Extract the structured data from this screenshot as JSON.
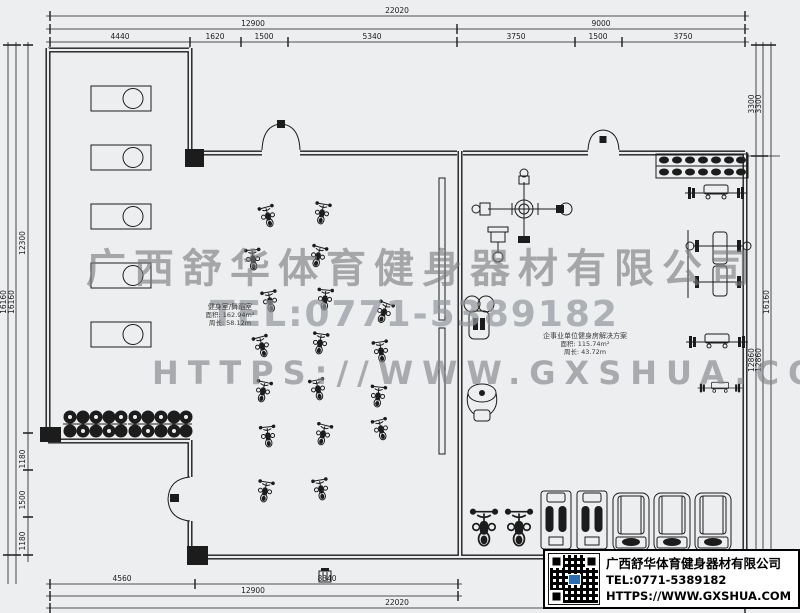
{
  "watermarks": {
    "company": "广西舒华体育健身器材有限公司",
    "tel": "TEL:0771-5389182",
    "website": "HTTPS://WWW.GXSHUA.COM"
  },
  "info_panel": {
    "company": "广西舒华体育健身器材有限公司",
    "tel": "TEL:0771-5389182",
    "website": "HTTPS://WWW.GXSHUA.COM"
  },
  "room_labels": {
    "spin_room": {
      "name": "健身室/舞蹈室",
      "area": "面积: 162.94m²",
      "perimeter": "周长: 58.12m"
    },
    "gym_room": {
      "name": "企事业单位健身房解决方案",
      "area": "面积: 115.74m²",
      "perimeter": "周长: 43.72m"
    }
  },
  "dims": {
    "t1": [
      "22020"
    ],
    "t2": [
      "12900",
      "9000"
    ],
    "t3": [
      "4440",
      "1620",
      "1500",
      "5340",
      "3750",
      "1500",
      "3750"
    ],
    "b1": [
      "4560",
      "8340"
    ],
    "b2": [
      "12900"
    ],
    "b3": [
      "22020"
    ],
    "l": [
      "16160",
      "16160",
      "12300",
      "1180",
      "1500",
      "1180"
    ],
    "r": [
      "3300",
      "3300",
      "12860",
      "12860",
      "16160"
    ]
  },
  "equipment_icons": [
    "treadmill-icon",
    "spin-bike-icon",
    "dumbbell-rack-icon",
    "barbell-bench-icon",
    "multi-station-icon",
    "lat-pulldown-icon",
    "bench-press-station-icon",
    "pec-deck-icon",
    "elliptical-icon",
    "squat-machine-icon",
    "upright-bike-icon",
    "door-swing-icon",
    "qr-code-icon",
    "column-icon",
    "mirror-icon",
    "plan-stamp-icon"
  ],
  "colors": {
    "background": "#edeef0",
    "line": "#1c1c1c",
    "watermark": "#a0a2a5",
    "panel_bg": "#ffffff",
    "panel_text": "#000000",
    "qr_logo": "#2a6fb5"
  }
}
